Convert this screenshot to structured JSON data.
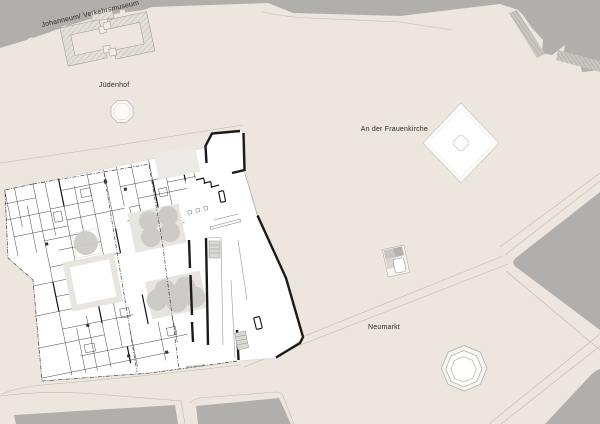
{
  "map": {
    "title": "Neumarkt Dresden site plan",
    "labels": {
      "johanneum": "Johanneum/ Verkehrsmuseum",
      "juedenhof": "Jüdenhof",
      "frauenkirche": "An der Frauenkirche",
      "neumarkt": "Neumarkt",
      "plot": "Teilgrundstück"
    },
    "colors": {
      "background": "#EDE6DF",
      "building_gray": "#B1AFAC",
      "building_light": "#E6E2DC",
      "plan_white": "#FFFFFF",
      "courtyard_gray": "#E8E5E0",
      "tree_gray": "#CBCAC6",
      "wall_black": "#1A1A1A",
      "thin_wall": "#3E3E3E",
      "road_line": "#C3BAB0",
      "text": "#2B2824"
    }
  }
}
